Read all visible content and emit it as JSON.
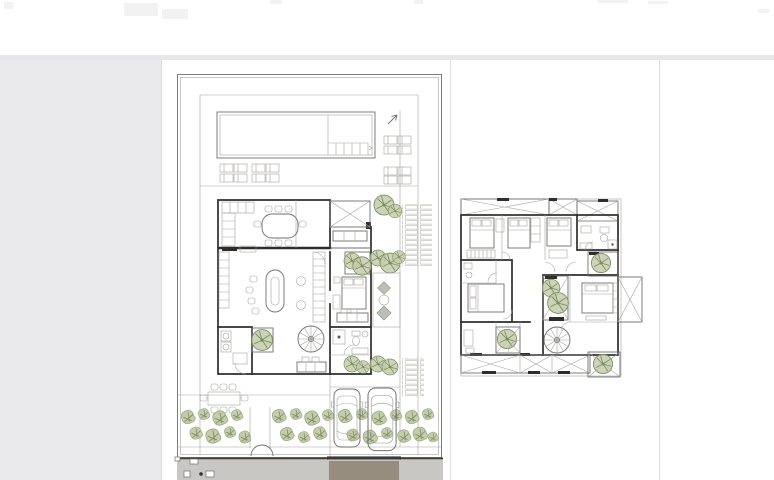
{
  "viewer": {
    "name": "drawing-viewer",
    "page_count_visible": 1,
    "plans": [
      {
        "id": "ground-floor-plan",
        "features": [
          "plot-frame",
          "swimming-pool",
          "pool-steps",
          "sun-loungers",
          "north-arrow",
          "kitchen",
          "dining-table",
          "living-room",
          "spiral-staircase",
          "bedroom",
          "bathroom",
          "laundry",
          "courtyard-trees",
          "patio-stepping-stones",
          "paving-strips",
          "garden-table",
          "hedge-row",
          "entrance-gate",
          "car",
          "car",
          "street",
          "driveway-apron"
        ]
      },
      {
        "id": "upper-floor-plan",
        "features": [
          "pergola-x-panels",
          "bedroom",
          "bedroom",
          "bedroom",
          "bedroom",
          "bathroom",
          "bathroom",
          "central-courtyard",
          "courtyard-trees",
          "spiral-staircase",
          "balcony-x-panel",
          "wardrobes"
        ]
      }
    ]
  },
  "colors": {
    "canvas_gray": "#eaeaed",
    "top_band": "#e7e6e9",
    "page_white": "#ffffff",
    "page_divider": "#e0dfe3",
    "wall": "#2e2d2c",
    "line": "#6f6e6c",
    "light_line": "#a3a29f",
    "green_dark": "#7c8c60",
    "green_mid": "#97a67c",
    "green_light": "#c3ccab",
    "street_gray": "#c9c7c3",
    "driveway_brown": "#978d7e",
    "paving_gray": "#bcbfb4",
    "curb_dark": "#3f3e3b"
  }
}
